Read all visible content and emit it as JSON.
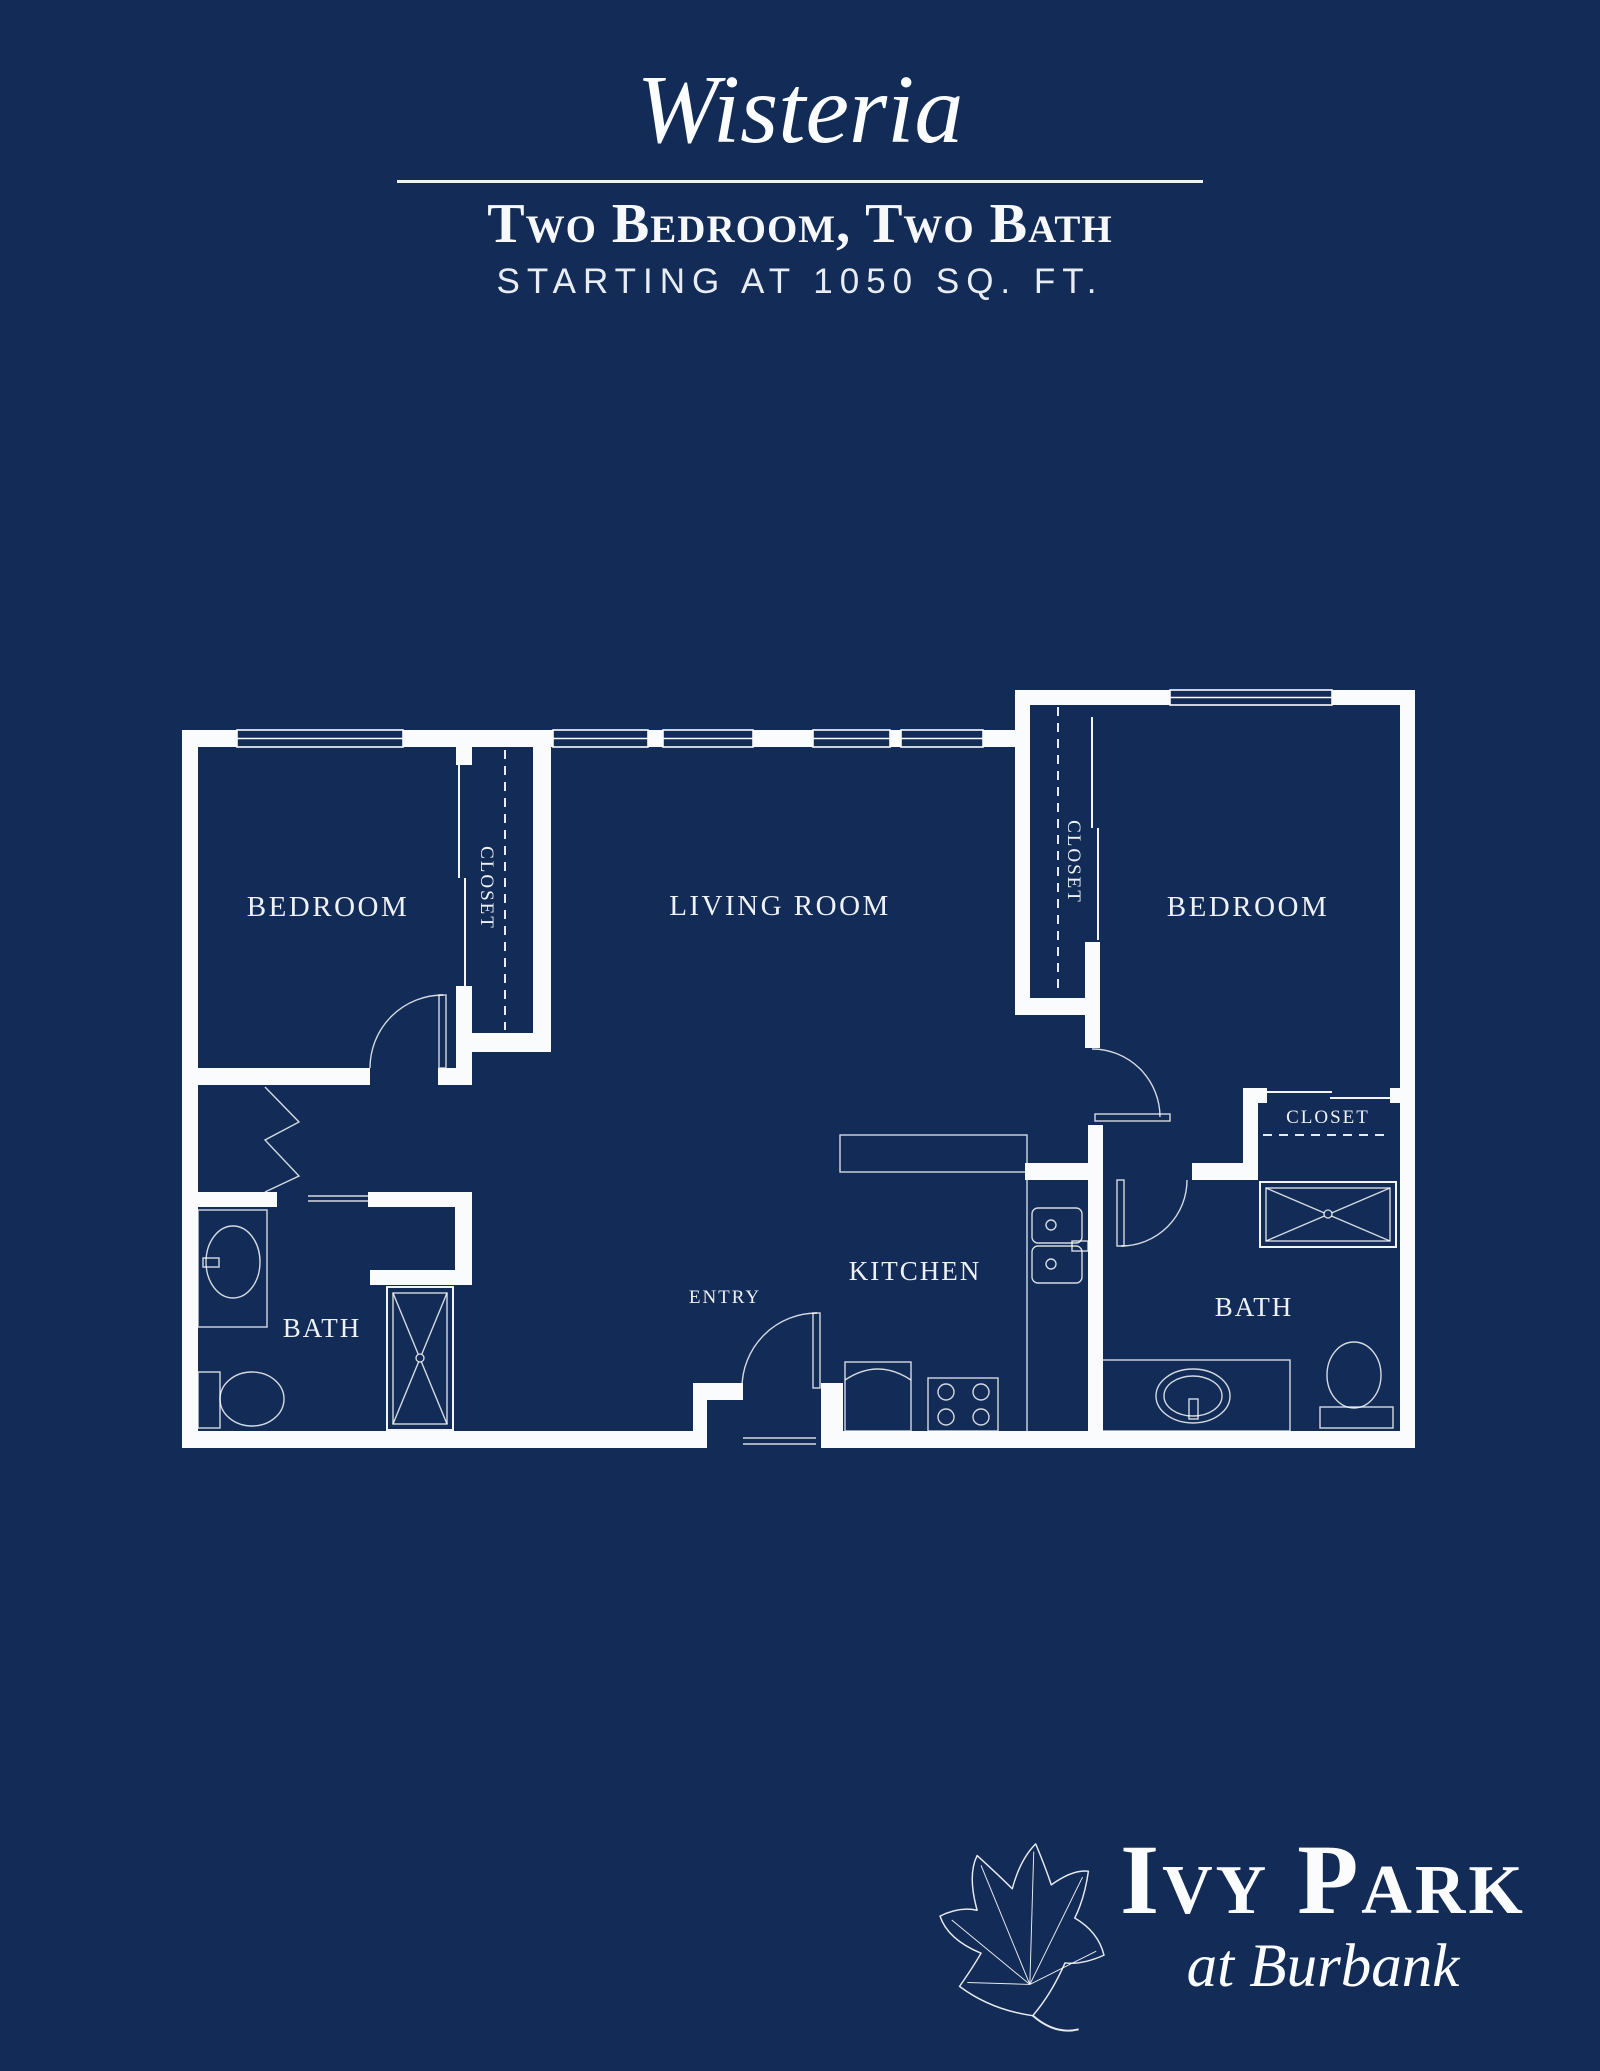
{
  "header": {
    "plan_name": "Wisteria",
    "subtitle": "Two Bedroom, Two Bath",
    "starting_at": "STARTING AT 1050 SQ. FT."
  },
  "rooms": {
    "bedroom_left": "BEDROOM",
    "living_room": "LIVING ROOM",
    "bedroom_right": "BEDROOM",
    "kitchen": "KITCHEN",
    "entry": "ENTRY",
    "bath_left": "BATH",
    "bath_right": "BATH",
    "closet_bedroom_left": "CLOSET",
    "closet_bedroom_right": "CLOSET",
    "closet_bath": "CLOSET"
  },
  "logo": {
    "brand": "Ivy Park",
    "tagline": "at Burbank"
  },
  "colors": {
    "background": "#122c57",
    "line": "#fafbfd"
  },
  "icons": {
    "leaf": "ivy-leaf-icon",
    "fixtures": [
      "toilet-icon",
      "sink-icon",
      "shower-icon",
      "stove-icon",
      "fridge-icon",
      "door-swing-icon",
      "window-icon"
    ]
  }
}
